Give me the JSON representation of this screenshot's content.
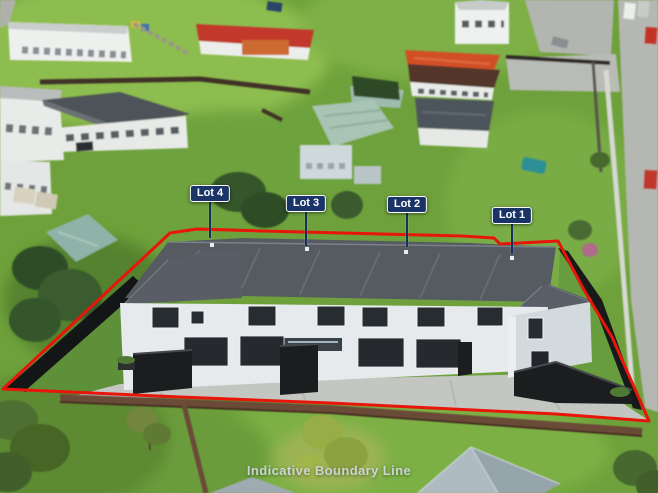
{
  "photo": {
    "caption": "Indicative Boundary Line"
  },
  "lot_labels": [
    {
      "label": "Lot 4"
    },
    {
      "label": "Lot 3"
    },
    {
      "label": "Lot 2"
    },
    {
      "label": "Lot 1"
    }
  ],
  "colors": {
    "boundary_line_red": "#e8150a",
    "lot_label_background_navy": "#1a3467",
    "lot_label_text": "#ffffff",
    "caption_text": "#cdd5d4"
  }
}
